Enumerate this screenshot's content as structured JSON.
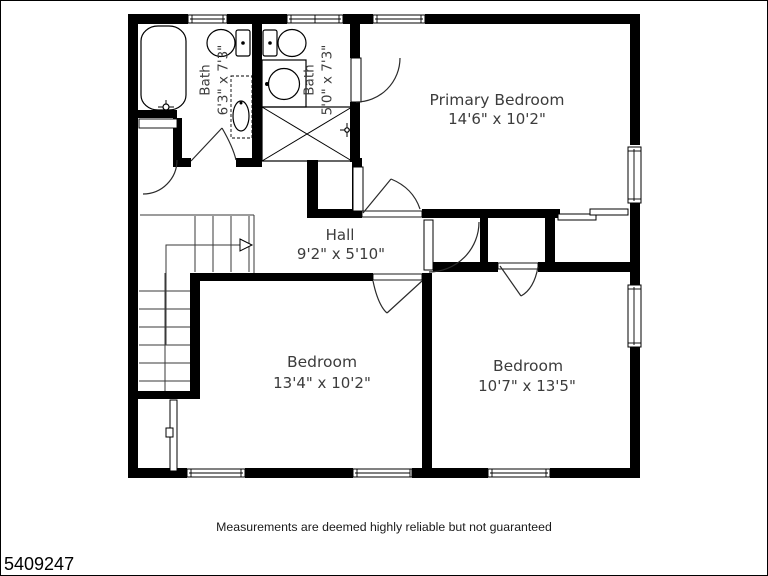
{
  "plan": {
    "listing_id": "5409247",
    "disclaimer": "Measurements are deemed highly reliable but not guaranteed",
    "rooms": {
      "primary_bedroom": {
        "name": "Primary Bedroom",
        "dims": "14'6\" x 10'2\""
      },
      "hall": {
        "name": "Hall",
        "dims": "9'2\" x 5'10\""
      },
      "bedroom_left": {
        "name": "Bedroom",
        "dims": "13'4\" x 10'2\""
      },
      "bedroom_right": {
        "name": "Bedroom",
        "dims": "10'7\" x 13'5\""
      },
      "bath_left": {
        "name": "Bath",
        "dims": "6'3\" x 7'3\""
      },
      "bath_right": {
        "name": "Bath",
        "dims": "5'0\" x 7'3\""
      }
    },
    "colors": {
      "wall": "#000000",
      "label": "#3c3c3c",
      "background": "#ffffff"
    }
  }
}
